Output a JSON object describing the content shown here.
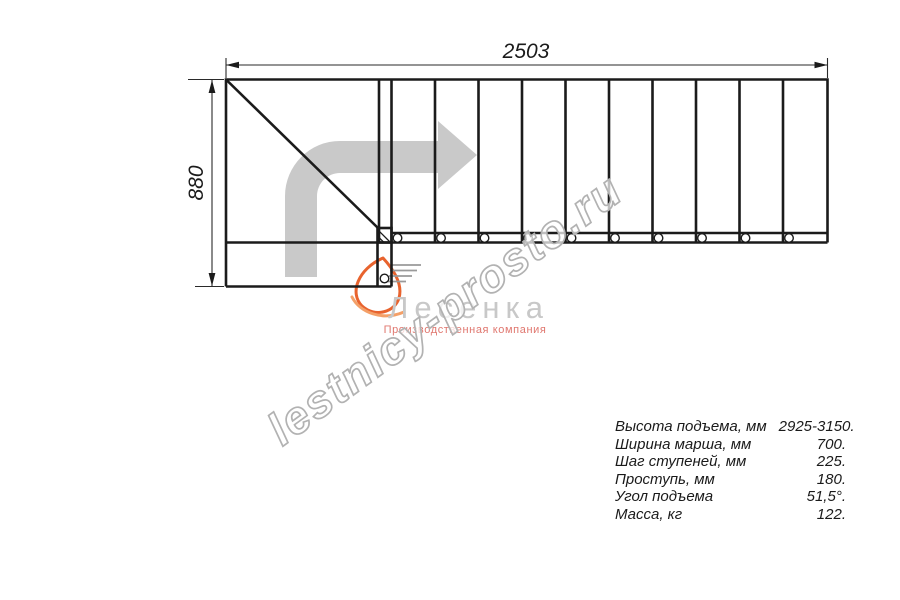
{
  "drawing": {
    "title": "Г-образная лестница — план",
    "dim_width_label": "2503",
    "dim_height_label": "880",
    "watermark_text": "lestnicy-prosto.ru",
    "logo": {
      "name": "Лесенка",
      "subtitle": "Производственная компания"
    },
    "colors": {
      "line_black": "#1b1b1b",
      "arrow_grey": "#c9c9c9",
      "watermark_grey": "#b2b2b2",
      "logo_grey": "#c8c8c8",
      "logo_red": "#e0776f",
      "flame_orange_dark": "#e8632e",
      "flame_orange_light": "#f4a068"
    }
  },
  "specs": {
    "rows": [
      {
        "label": "Высота подъема, мм",
        "value": "2925-3150."
      },
      {
        "label": "Ширина марша, мм",
        "value": "700."
      },
      {
        "label": "Шаг ступеней, мм",
        "value": "225."
      },
      {
        "label": "Проступь, мм",
        "value": "180."
      },
      {
        "label": "Угол подъема",
        "value": "51,5°."
      },
      {
        "label": "Масса, кг",
        "value": "122."
      }
    ]
  }
}
